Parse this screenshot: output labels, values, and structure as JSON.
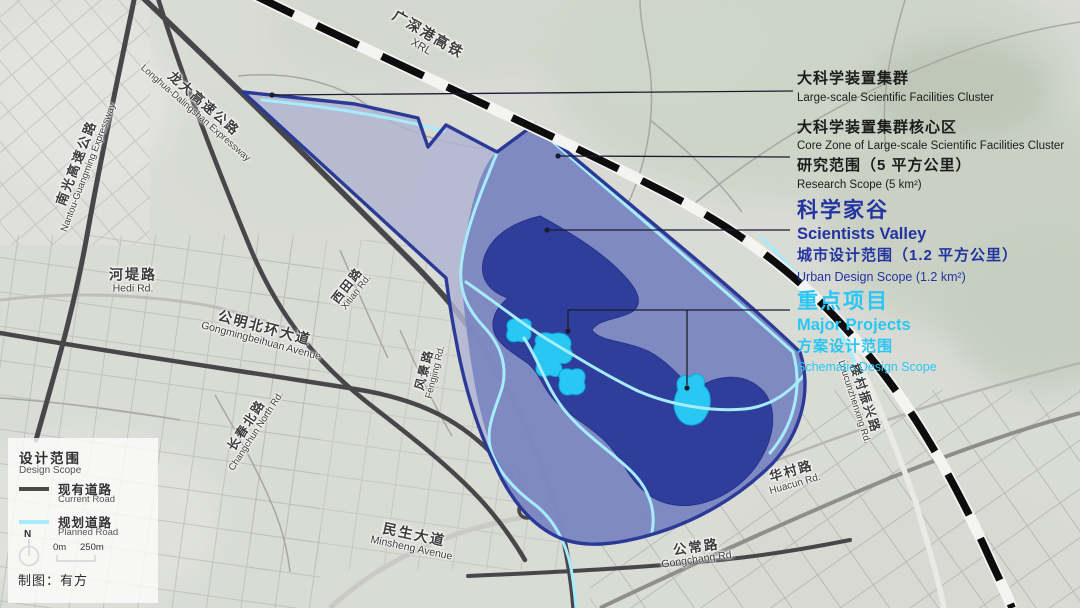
{
  "map_labels": {
    "railway": {
      "cn": "广深港高铁",
      "en": "XRL"
    },
    "roads": {
      "nantou": {
        "cn": "南光高速公路",
        "en": "Nantou-Guangming Expressway"
      },
      "longda": {
        "cn": "龙大高速公路",
        "en": "Longhua-Dalingshan Expressway"
      },
      "hedi": {
        "cn": "河堤路",
        "en": "Hedi Rd."
      },
      "xitian": {
        "cn": "西田路",
        "en": "Xitian Rd."
      },
      "gongmingbeihuan": {
        "cn": "公明北环大道",
        "en": "Gongmingbeihuan Avenue"
      },
      "changchun": {
        "cn": "长春北路",
        "en": "Changchun North Rd."
      },
      "fengjing": {
        "cn": "风景路",
        "en": "Fengjing Rd."
      },
      "minsheng": {
        "cn": "民生大道",
        "en": "Minsheng Avenue"
      },
      "huacun": {
        "cn": "华村路",
        "en": "Huacun Rd."
      },
      "gongchang": {
        "cn": "公常路",
        "en": "Gongchang Rd."
      },
      "loucunzhenxing": {
        "cn": "楼村振兴路",
        "en": "Loucunzhenxing Rd."
      }
    }
  },
  "annotations": {
    "facilities_cluster": {
      "cn": "大科学装置集群",
      "en": "Large-scale Scientific Facilities Cluster"
    },
    "core_zone": {
      "cn": "大科学装置集群核心区",
      "en": "Core Zone of Large-scale Scientific Facilities Cluster"
    },
    "research_scope": {
      "cn": "研究范围（5 平方公里）",
      "en": "Research Scope (5 km²)"
    },
    "valley": {
      "cn": "科学家谷",
      "en": "Scientists Valley"
    },
    "urban_design": {
      "cn": "城市设计范围（1.2 平方公里）",
      "en": "Urban Design Scope (1.2 km²)"
    },
    "major_projects": {
      "cn": "重点项目",
      "en": "Major Projects"
    },
    "schematic": {
      "cn": "方案设计范围",
      "en": "Schematic Design Scope"
    }
  },
  "legend": {
    "title_cn": "设计范围",
    "title_en": "Design Scope",
    "current_road_cn": "现有道路",
    "current_road_en": "Current Road",
    "planned_road_cn": "规划道路",
    "planned_road_en": "Planned Road",
    "north": "N",
    "scale_start": "0m",
    "scale_end": "250m",
    "credit": "制图：有方"
  },
  "colors": {
    "research_scope_fill": "#aeb3d2",
    "core_zone_fill": "#7b86c0",
    "valley_fill": "#2f3e9b",
    "scope_border": "#2b3a96",
    "major_project_cyan": "#28c8f3",
    "planned_road_cyan": "#a6ecfc",
    "annotation_blue": "#2334a0",
    "annotation_cyan": "#2bc7f4",
    "current_road_gray": "#4a4a48"
  }
}
